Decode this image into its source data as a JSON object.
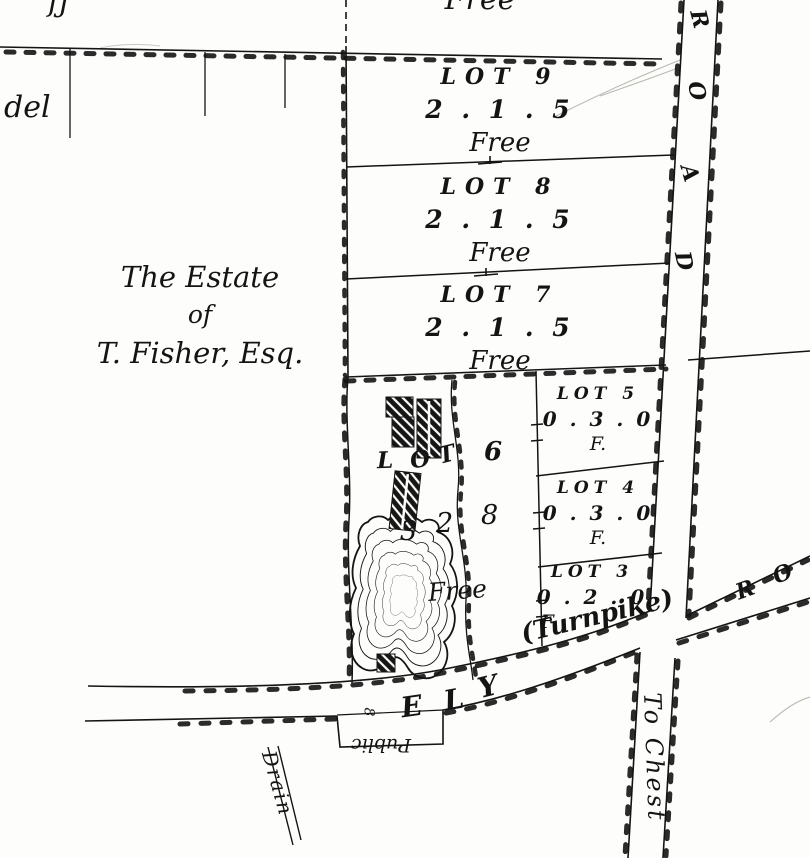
{
  "map": {
    "paper_color": "#fdfdfb",
    "ink_color": "#141414",
    "top_fragment": "Free",
    "top_left_fragment": "fj",
    "left_label": "del",
    "estate": {
      "line1": "The Estate",
      "line2": "of",
      "line3": "T. Fisher, Esq."
    },
    "lots": [
      {
        "name": "LOT 9",
        "area": "2 . 1 . 5",
        "tenure": "Free"
      },
      {
        "name": "LOT 8",
        "area": "2 . 1 . 5",
        "tenure": "Free"
      },
      {
        "name": "LOT 7",
        "area": "2 . 1 . 5",
        "tenure": "Free"
      },
      {
        "name": "LOT 5",
        "area": "0 . 3 . 0",
        "tenure": "F."
      },
      {
        "name": "LOT 4",
        "area": "0 . 3 . 0",
        "tenure": "F."
      },
      {
        "name": "LOT 3",
        "area": "0 . 2 . 0",
        "tenure": "F."
      }
    ],
    "lot6": {
      "letters": [
        "L",
        "O",
        "T",
        "6"
      ],
      "area_digits": [
        "3",
        "2",
        "8"
      ],
      "tenure": "Free"
    },
    "roads": {
      "ely_letters": [
        "E",
        "L",
        "Y"
      ],
      "ely_suffix": "(Turnpike)",
      "north_letters": [
        "R",
        "O",
        "A",
        "D"
      ],
      "northeast_letters": [
        "R",
        "O"
      ],
      "south_label": "To Chest",
      "width_note": "8"
    },
    "drain": {
      "line1": "Public",
      "line2": "Drain"
    }
  }
}
